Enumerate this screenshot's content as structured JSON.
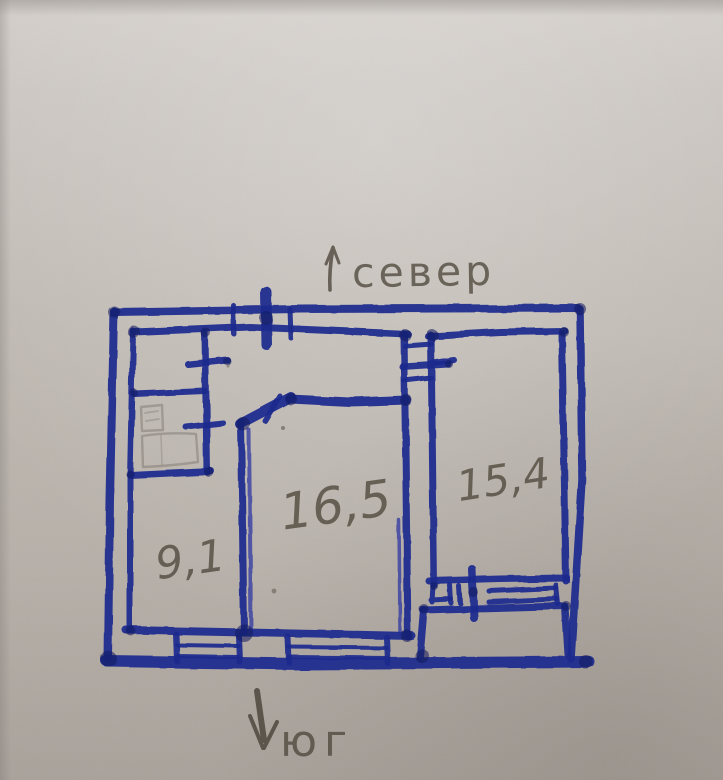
{
  "compass": {
    "north": {
      "label": "север",
      "icon": "up-arrow-icon"
    },
    "south": {
      "label": "юг",
      "icon": "down-arrow-icon"
    }
  },
  "rooms": [
    {
      "id": "room-bottom-left",
      "area_label": "9,1"
    },
    {
      "id": "room-center",
      "area_label": "16,5"
    },
    {
      "id": "room-right",
      "area_label": "15,4"
    }
  ],
  "colors": {
    "ink": "#1f2a8e",
    "ink_dark": "#121a5e",
    "pencil": "#575047",
    "paper": "#bfb9b2"
  }
}
